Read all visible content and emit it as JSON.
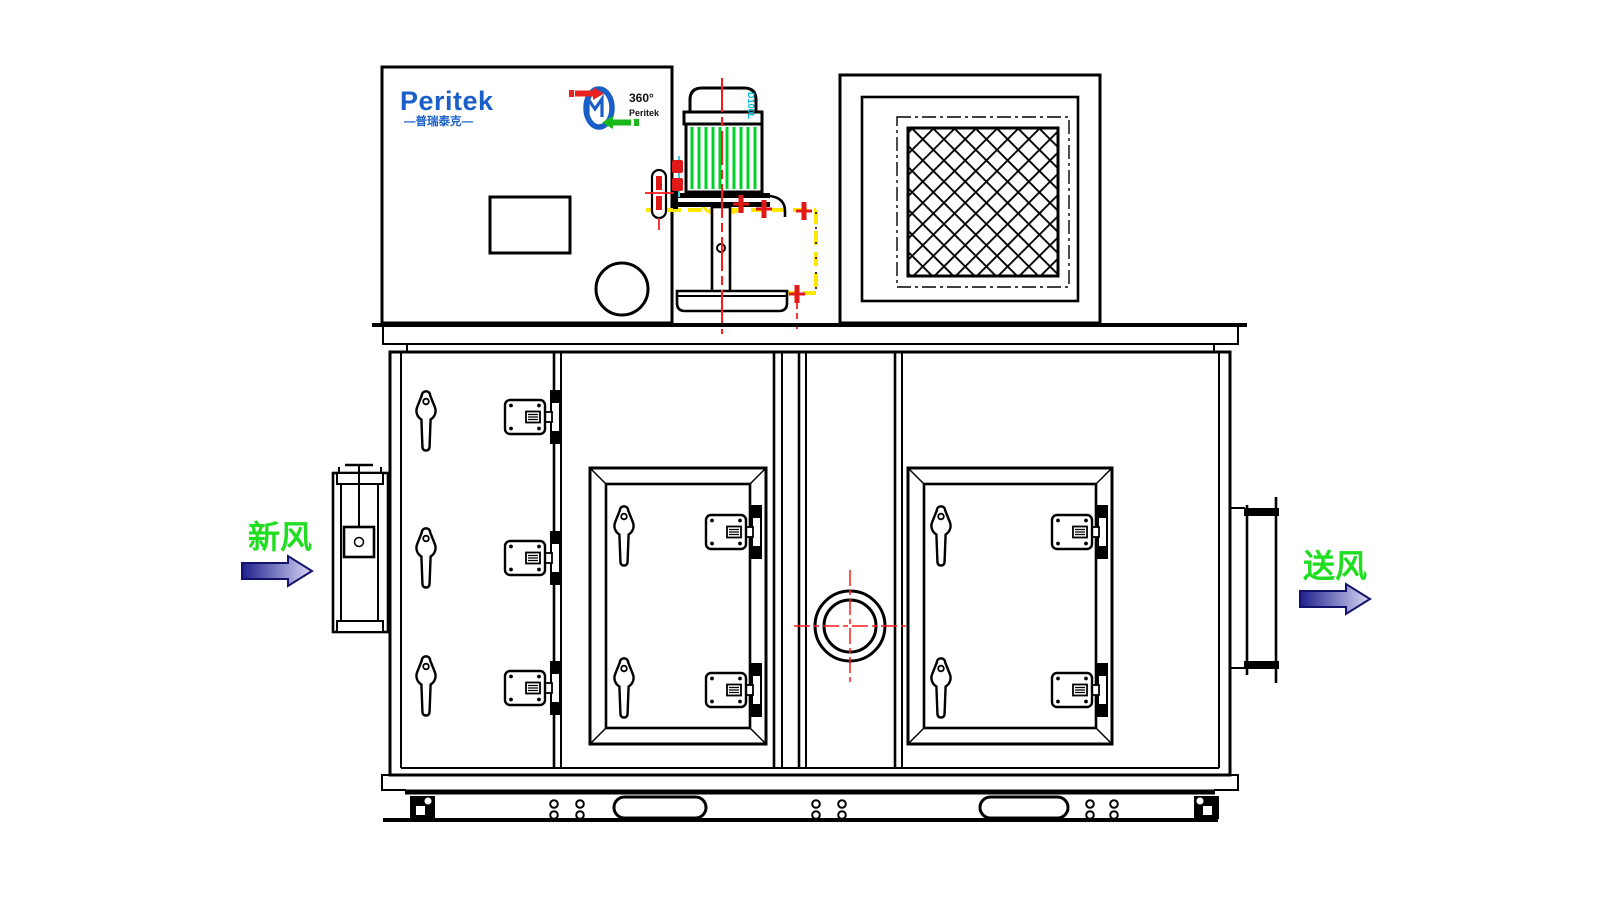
{
  "branding": {
    "logo_text": "Peritek",
    "logo_subtext": "—普瑞泰克—",
    "badge": {
      "line1": "360°",
      "line2": "Peritek"
    }
  },
  "motor": {
    "frame_label": "D100L"
  },
  "flow": {
    "inlet_label": "新风",
    "outlet_label": "送风"
  },
  "colors": {
    "line_black": "#000000",
    "logo_blue": "#1a5fc8",
    "label_green": "#1fdd1f",
    "centerline_red": "#ff1a1a",
    "hidden_yellow": "#ffe800",
    "fin_green": "#00d02a",
    "motor_label_cyan": "#00b8d8",
    "bolt_red": "#e01818",
    "arrow_dark_blue": "#20208e",
    "arrow_light_blue": "#d8d8f6"
  },
  "icons": {
    "rotor-badge-icon": "desiccant wheel with red/green airflow arrows",
    "inlet-arrow-icon": "flow arrow pointing right",
    "outlet-arrow-icon": "flow arrow pointing right"
  }
}
